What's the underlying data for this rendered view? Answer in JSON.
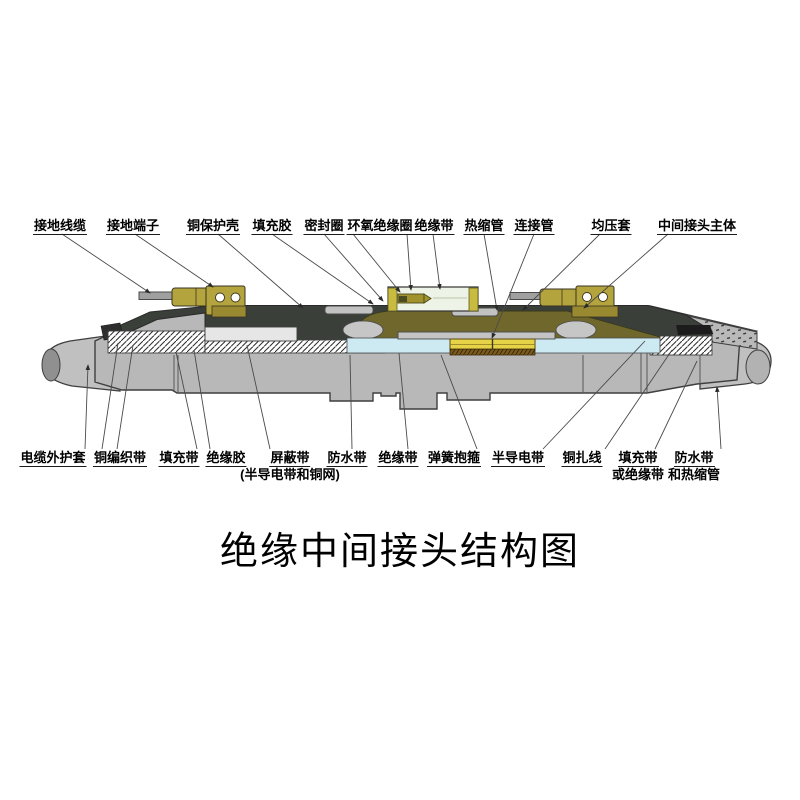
{
  "title": "绝缘中间接头结构图",
  "labels_top": [
    {
      "id": "grounding-cable",
      "text": "接地线缆"
    },
    {
      "id": "grounding-terminal",
      "text": "接地端子"
    },
    {
      "id": "copper-protective-shell",
      "text": "铜保护壳"
    },
    {
      "id": "filling-glue",
      "text": "填充胶"
    },
    {
      "id": "sealing-ring",
      "text": "密封圈"
    },
    {
      "id": "epoxy-insulation-ring",
      "text": "环氧绝缘圈"
    },
    {
      "id": "insulation-tape",
      "text": "绝缘带"
    },
    {
      "id": "heat-shrink-tube",
      "text": "热缩管"
    },
    {
      "id": "connecting-tube",
      "text": "连接管"
    },
    {
      "id": "equalizing-sleeve",
      "text": "均压套"
    },
    {
      "id": "joint-main-body",
      "text": "中间接头主体"
    }
  ],
  "labels_bottom": [
    {
      "id": "cable-outer-sheath",
      "text": "电缆外护套"
    },
    {
      "id": "copper-braid-tape",
      "text": "铜编织带"
    },
    {
      "id": "filling-tape",
      "text": "填充带"
    },
    {
      "id": "insulation-glue",
      "text": "绝缘胶"
    },
    {
      "id": "shielding-tape",
      "text": "屏蔽带",
      "line2": "(半导电带和铜网)"
    },
    {
      "id": "waterproof-tape",
      "text": "防水带"
    },
    {
      "id": "insulation-tape-2",
      "text": "绝缘带"
    },
    {
      "id": "spring-clamp",
      "text": "弹簧抱箍"
    },
    {
      "id": "semi-conductive-tape",
      "text": "半导电带"
    },
    {
      "id": "copper-binding-wire",
      "text": "铜扎线"
    },
    {
      "id": "filling-or-insulation-tape",
      "text": "填充带",
      "line2": "或绝缘带"
    },
    {
      "id": "waterproof-and-heatshrink",
      "text": "防水带",
      "line2": "和热缩管"
    }
  ],
  "colors": {
    "outline": "#3f3f3f",
    "body_gray": "#b8b8b8",
    "sheath_gray": "#c0c0c0",
    "core_gray": "#909090",
    "dark_band": "#3a3f3a",
    "olive": "#6f672c",
    "cyan": "#cdeaf2",
    "yellow": "#e7d348",
    "brown": "#7b5a1d",
    "brass": "#b4a43e",
    "brass_dark": "#998930",
    "box_bg": "#eef3e7",
    "box_strip": "#c9ba40"
  }
}
